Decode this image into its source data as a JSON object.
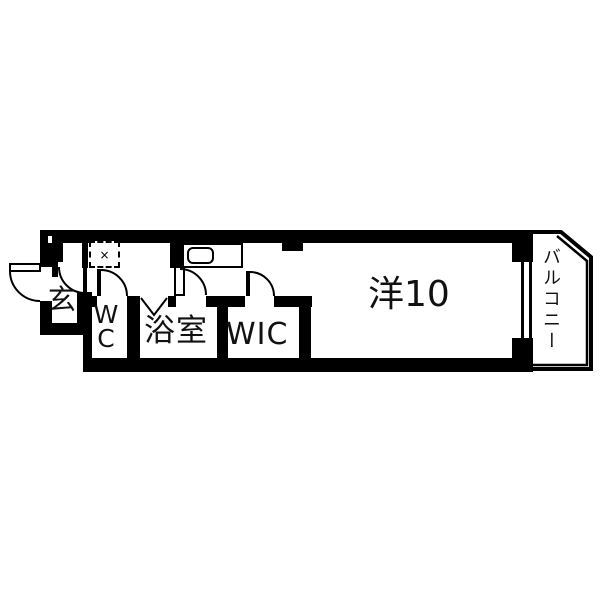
{
  "floorplan": {
    "rooms": {
      "genkan": {
        "label": "玄"
      },
      "wc": {
        "label": "WC",
        "lines": [
          "W",
          "C"
        ]
      },
      "bathroom": {
        "label": "浴室"
      },
      "wic": {
        "label": "WIC"
      },
      "western_room": {
        "label": "洋10"
      },
      "balcony": {
        "label": "バルコニー"
      }
    },
    "symbols": {
      "utility_cross": "×"
    },
    "colors": {
      "wall": "#000000",
      "background": "#ffffff",
      "line": "#000000"
    }
  }
}
